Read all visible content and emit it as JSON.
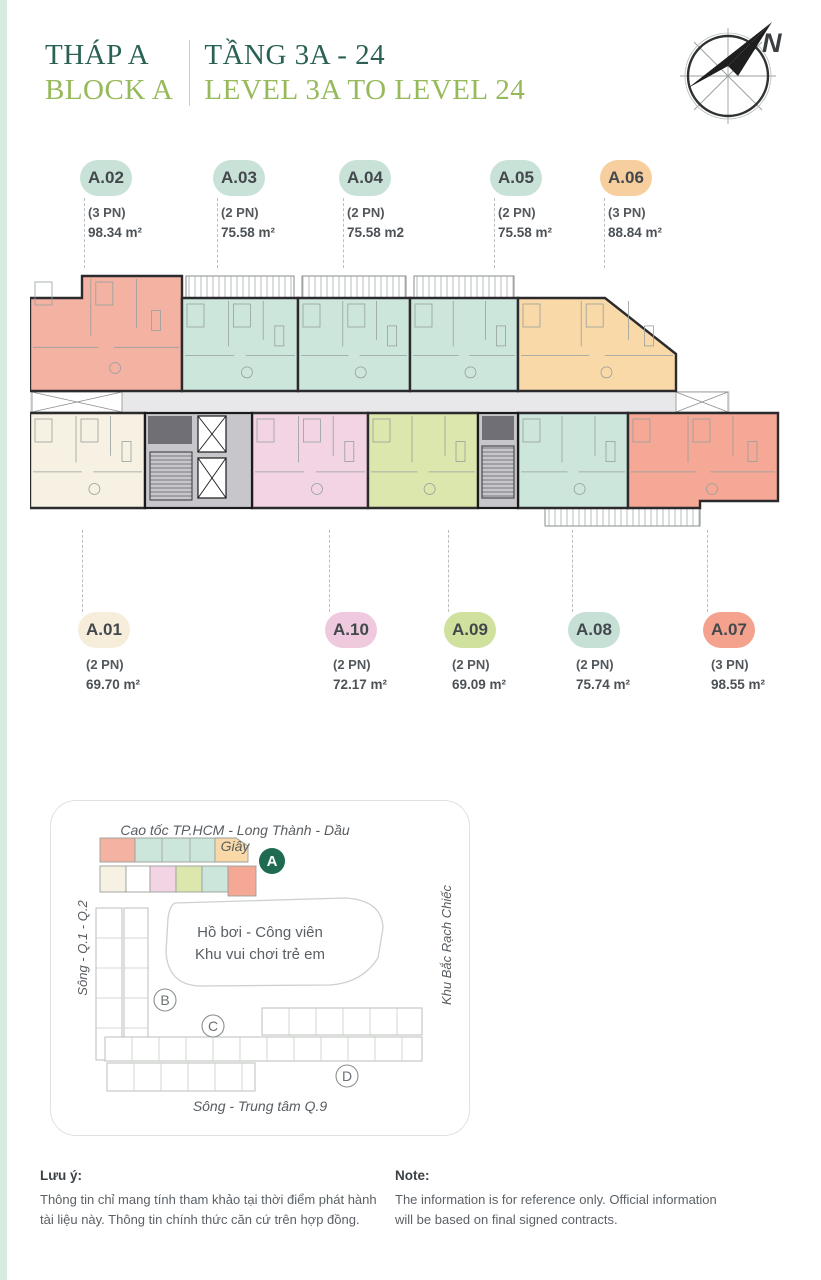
{
  "theme": {
    "primary": "#2a6154",
    "secondary": "#96b95a",
    "edge_strip": "#d7ebe0",
    "dash": "#b9bfc1",
    "text_dark": "#43484d",
    "text_mid": "#5a6065"
  },
  "header": {
    "title_vi": "THÁP A",
    "title_en": "BLOCK A",
    "range_vi": "TẦNG 3A - 24",
    "range_en": "LEVEL 3A TO LEVEL 24"
  },
  "compass": {
    "label": "N"
  },
  "units": {
    "top": [
      {
        "id": "A.02",
        "bedrooms": "(3 PN)",
        "area": "98.34 m²",
        "pill_color": "#c9e2d8",
        "x": 80
      },
      {
        "id": "A.03",
        "bedrooms": "(2 PN)",
        "area": "75.58 m²",
        "pill_color": "#c9e2d8",
        "x": 213
      },
      {
        "id": "A.04",
        "bedrooms": "(2 PN)",
        "area": "75.58 m2",
        "pill_color": "#c9e2d8",
        "x": 339
      },
      {
        "id": "A.05",
        "bedrooms": "(2 PN)",
        "area": "75.58 m²",
        "pill_color": "#c9e2d8",
        "x": 490
      },
      {
        "id": "A.06",
        "bedrooms": "(3 PN)",
        "area": "88.84 m²",
        "pill_color": "#f7cf9e",
        "x": 600
      }
    ],
    "bottom": [
      {
        "id": "A.01",
        "bedrooms": "(2 PN)",
        "area": "69.70 m²",
        "pill_color": "#f6eeda",
        "x": 78
      },
      {
        "id": "A.10",
        "bedrooms": "(2 PN)",
        "area": "72.17 m²",
        "pill_color": "#efc9de",
        "x": 325
      },
      {
        "id": "A.09",
        "bedrooms": "(2 PN)",
        "area": "69.09 m²",
        "pill_color": "#cfe19c",
        "x": 444
      },
      {
        "id": "A.08",
        "bedrooms": "(2 PN)",
        "area": "75.74 m²",
        "pill_color": "#c6e0d6",
        "x": 568
      },
      {
        "id": "A.07",
        "bedrooms": "(3 PN)",
        "area": "98.55 m²",
        "pill_color": "#f4a28e",
        "x": 703
      }
    ]
  },
  "floor_plan": {
    "wall_color": "#2b2b2e",
    "corridor_color": "#e8e8eb",
    "core_color": "#c6c6cb",
    "detail_color": "#96a09d",
    "balcony_stroke": "#7c8280",
    "units": [
      {
        "id": "A.02",
        "color": "#f4b2a3",
        "points": "0,32 52,32 52,10 152,10 152,125 0,125"
      },
      {
        "id": "A.03",
        "color": "#cde6dc",
        "points": "152,32 268,32 268,125 152,125"
      },
      {
        "id": "A.04",
        "color": "#cde6dc",
        "points": "268,32 380,32 380,125 268,125"
      },
      {
        "id": "A.05",
        "color": "#cde6dc",
        "points": "380,32 488,32 488,125 380,125"
      },
      {
        "id": "A.06",
        "color": "#f9d9a8",
        "points": "488,32 575,32 646,88 646,125 488,125"
      },
      {
        "id": "A.01",
        "color": "#f6f1e3",
        "points": "0,147 115,147 115,242 0,242"
      },
      {
        "id": "A.10",
        "color": "#f2d4e4",
        "points": "222,147 338,147 338,242 222,242"
      },
      {
        "id": "A.09",
        "color": "#dbe7ad",
        "points": "338,147 448,147 448,242 338,242"
      },
      {
        "id": "A.08",
        "color": "#cde6dc",
        "points": "488,147 598,147 598,242 488,242"
      },
      {
        "id": "A.07",
        "color": "#f4a895",
        "points": "598,147 748,147 748,235 670,235 670,242 598,242"
      }
    ],
    "corridor": {
      "x": 0,
      "y": 125,
      "w": 700,
      "h": 22
    },
    "xboxes": [
      [
        2,
        126,
        90,
        20
      ],
      [
        646,
        126,
        52,
        20
      ]
    ],
    "balconies": [
      [
        156,
        10,
        108,
        22
      ],
      [
        272,
        10,
        104,
        22
      ],
      [
        384,
        10,
        100,
        22
      ],
      [
        515,
        242,
        155,
        18
      ]
    ],
    "cores": [
      {
        "rect": [
          115,
          147,
          107,
          95
        ],
        "dark": [
          118,
          150,
          44,
          28
        ],
        "elevators": [
          [
            168,
            150,
            28,
            36
          ],
          [
            168,
            192,
            28,
            40
          ]
        ],
        "stair": [
          120,
          186,
          42,
          48
        ]
      },
      {
        "rect": [
          448,
          147,
          40,
          95
        ],
        "dark": [
          452,
          150,
          32,
          24
        ],
        "elevators": [],
        "stair": [
          452,
          180,
          32,
          52
        ]
      }
    ]
  },
  "site_map": {
    "road_top": "Cao tốc TP.HCM - Long Thành - Dầu Giây",
    "road_bottom": "Sông - Trung tâm Q.9",
    "left_label": "Sông - Q.1 - Q.2",
    "right_label": "Khu Bắc Rạch Chiếc",
    "pool_line1": "Hồ bơi - Công viên",
    "pool_line2": "Khu vui chơi trẻ em",
    "badge": {
      "label": "A",
      "color": "#1e6b52",
      "x": 222,
      "y": 61
    },
    "circles": [
      {
        "label": "B",
        "x": 115,
        "y": 200
      },
      {
        "label": "C",
        "x": 163,
        "y": 226
      },
      {
        "label": "D",
        "x": 297,
        "y": 276
      }
    ],
    "mini_blocks": [
      {
        "color": "#f4b2a3",
        "rect": [
          50,
          38,
          35,
          24
        ]
      },
      {
        "color": "#cde6dc",
        "rect": [
          85,
          38,
          80,
          24
        ]
      },
      {
        "color": "#f9d9a8",
        "poly": "165,38 186,38 198,46 198,62 165,62"
      },
      {
        "color": "#f6f1e3",
        "rect": [
          50,
          66,
          26,
          26
        ]
      },
      {
        "color": "#ffffff",
        "rect": [
          76,
          66,
          24,
          26
        ]
      },
      {
        "color": "#f2d4e4",
        "rect": [
          100,
          66,
          26,
          26
        ]
      },
      {
        "color": "#dbe7ad",
        "rect": [
          126,
          66,
          26,
          26
        ]
      },
      {
        "color": "#cde6dc",
        "rect": [
          152,
          66,
          26,
          26
        ]
      },
      {
        "color": "#f4a895",
        "rect": [
          178,
          66,
          28,
          30
        ]
      }
    ],
    "outline_blocks": [
      [
        46,
        108,
        26,
        152
      ],
      [
        74,
        108,
        24,
        136
      ],
      [
        212,
        208,
        160,
        27
      ],
      [
        55,
        237,
        317,
        24
      ],
      [
        57,
        263,
        148,
        28
      ]
    ],
    "pool_path": "M125,103 L295,98 Q332,100 333,128 L328,158 Q312,183 280,185 L150,186 Q118,185 116,152 L118,118 Q120,105 125,103 Z"
  },
  "footer": {
    "vi_title": "Lưu ý:",
    "vi_body": "Thông tin chỉ mang tính tham khảo tại thời điểm phát hành tài liệu này. Thông tin chính thức căn cứ trên hợp đồng.",
    "en_title": "Note:",
    "en_body": "The information is for reference only. Official information will be based on final signed contracts."
  }
}
